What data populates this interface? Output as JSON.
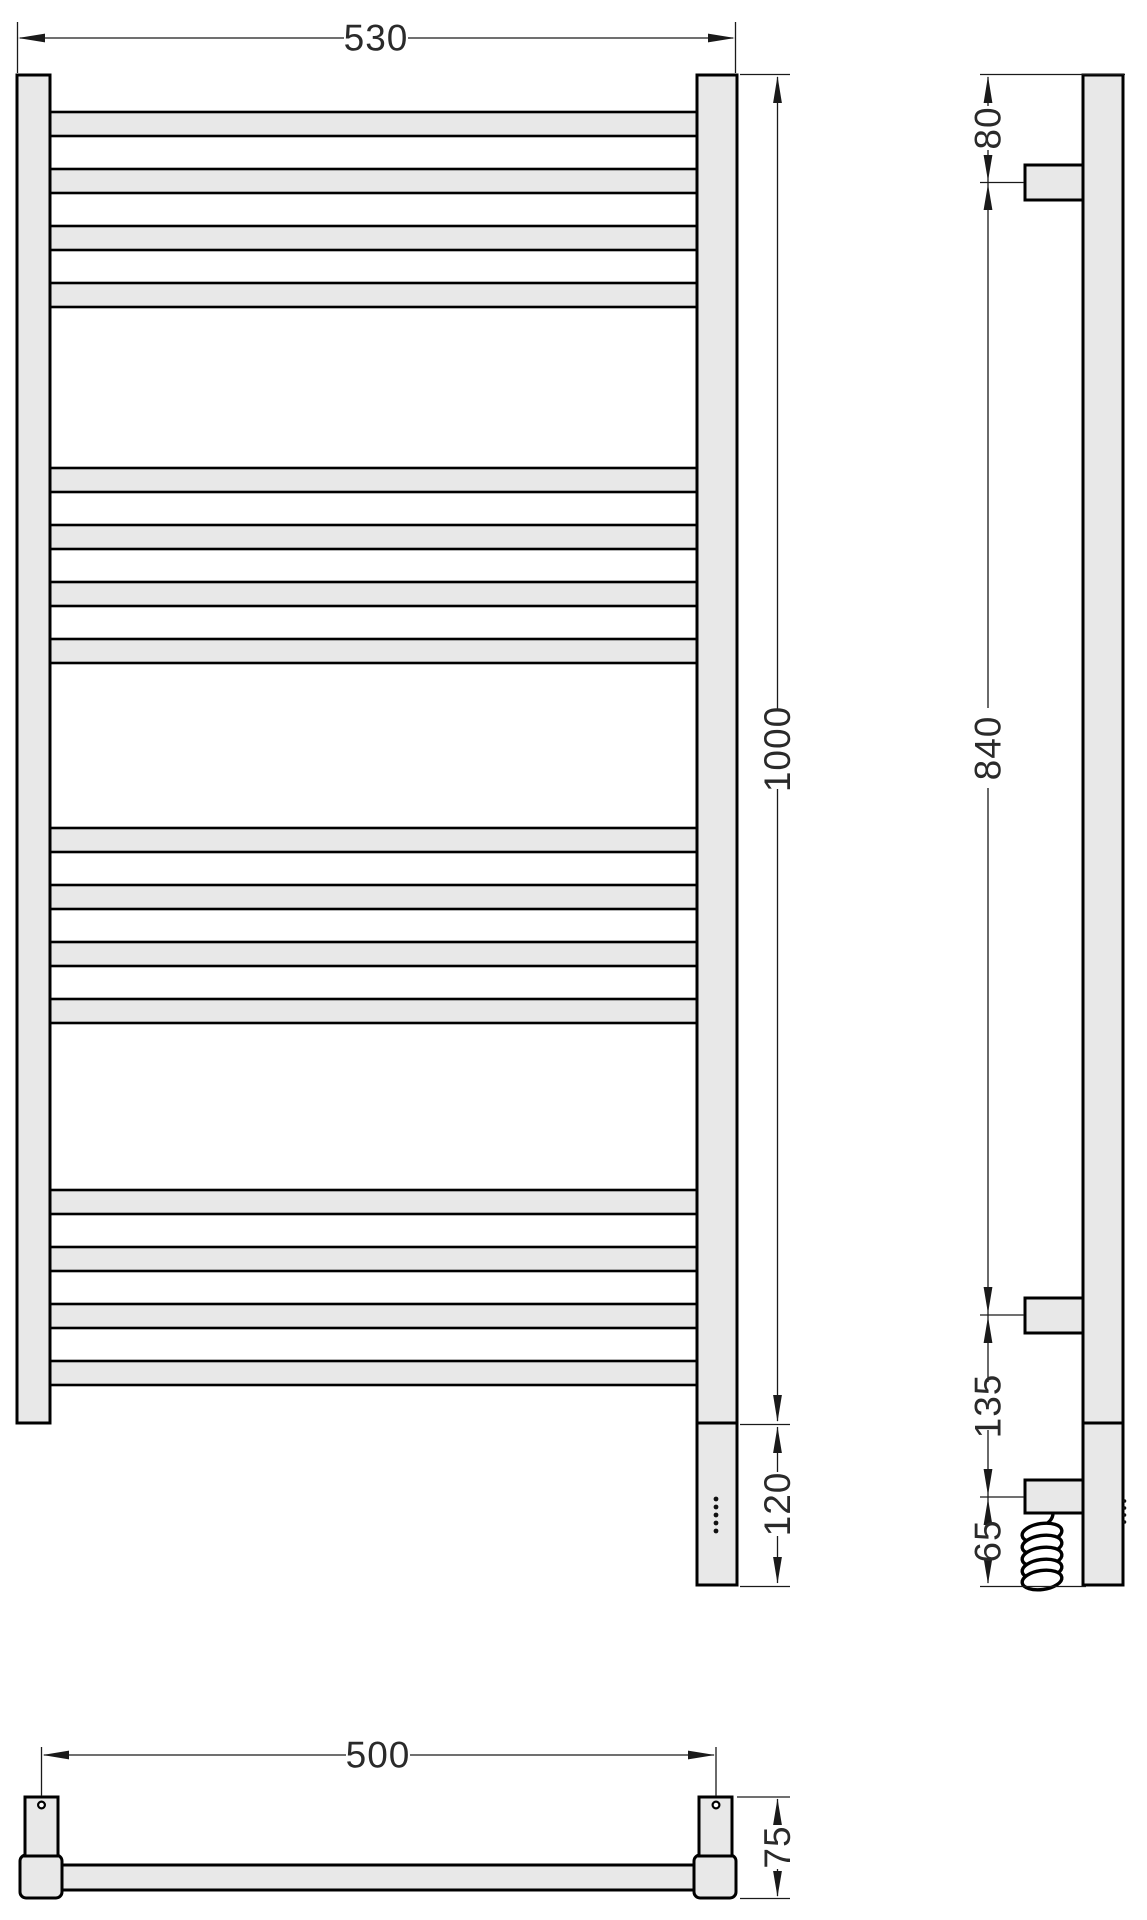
{
  "drawing": {
    "type": "technical-dimension-drawing",
    "subject": "ladder towel rail / heated towel warmer shown in front, side and bottom projections",
    "colors": {
      "part_fill": "#e8e8e8",
      "outline": "#000000",
      "dimension_line": "#1a1a1a",
      "background": "#ffffff"
    },
    "structure": {
      "rung_groups": 4,
      "rungs_per_group": 4,
      "indicator_dots": 5,
      "cable_coil_loops": 5
    },
    "dimensions": {
      "front_width": "530",
      "front_height": "1000",
      "heater_unit_height": "120",
      "top_to_bracket": "80",
      "bracket_spacing": "840",
      "bracket_to_cable": "135",
      "cable_to_bottom": "65",
      "mounting_width": "500",
      "bracket_depth": "75"
    }
  }
}
